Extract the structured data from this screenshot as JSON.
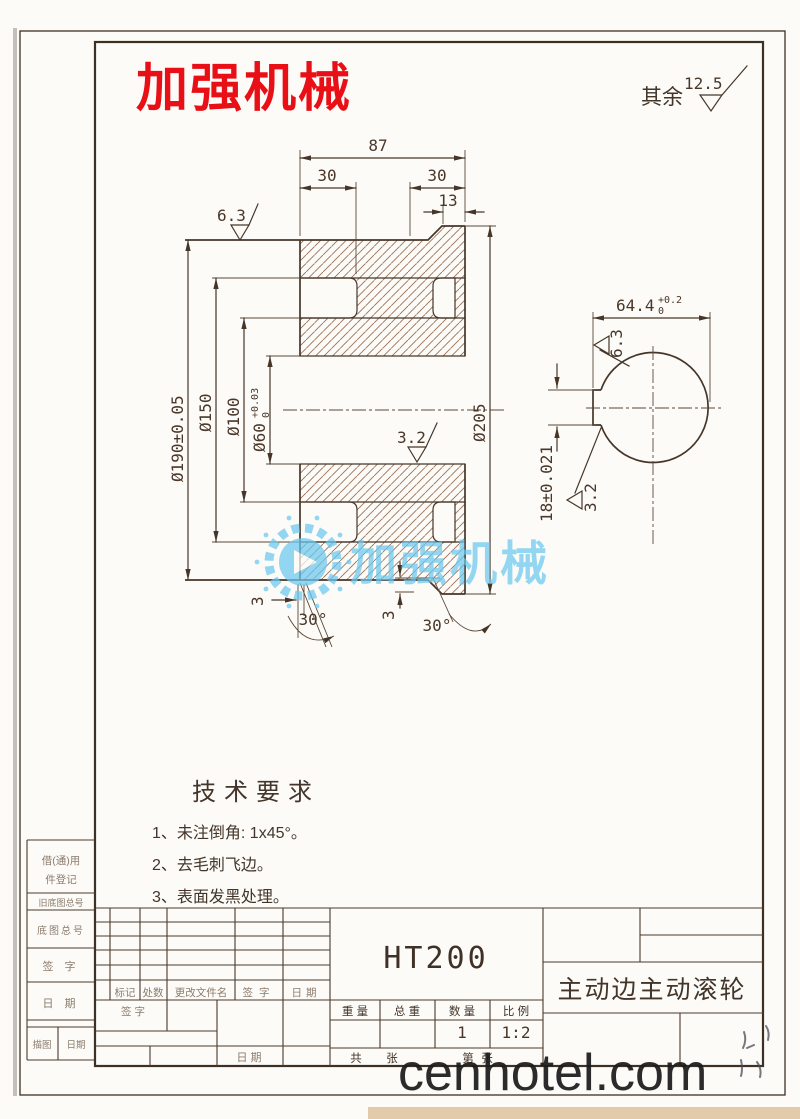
{
  "watermarks": {
    "red_brand": "加强机械",
    "center_brand": "加强机械",
    "site": "cenhotel.com"
  },
  "surface_note": {
    "label": "其余",
    "value": "12.5"
  },
  "main_view": {
    "dims": {
      "total_width": "87",
      "left_width": "30",
      "right_width": "30",
      "rim_width": "13",
      "dia_outer": "Ø190±0.05",
      "dia_groove": "Ø150",
      "dia_hub": "Ø100",
      "dia_bore": "Ø60",
      "dia_bore_tol_up": "+0.03",
      "dia_bore_tol_low": "0",
      "dia_rim": "Ø205",
      "finish_face": "6.3",
      "finish_bore": "3.2",
      "chamfer_left_depth": "3",
      "chamfer_left_angle": "30°",
      "chamfer_right_depth": "3",
      "chamfer_right_angle": "30°"
    }
  },
  "side_view": {
    "dims": {
      "keyway_span": "64.4",
      "keyway_span_tol_up": "+0.2",
      "keyway_span_tol_low": "0",
      "keyway_width": "18±0.021",
      "finish_bore": "6.3",
      "finish_keyway": "3.2"
    }
  },
  "tech_requirements": {
    "title": "技术要求",
    "items": [
      "1、未注倒角: 1x45°。",
      "2、去毛刺飞边。",
      "3、表面发黑处理。"
    ]
  },
  "title_block": {
    "material": "HT200",
    "part_name": "主动边主动滚轮",
    "rev_cols": [
      "标记",
      "处数",
      "更改文件名",
      "签字",
      "日期"
    ],
    "sign_label": "签 字",
    "date_label": "日 期",
    "spec_cols": [
      "重 量",
      "总 重",
      "数 量",
      "比 例"
    ],
    "qty_value": "1",
    "scale_value": "1:2",
    "sheet_row": [
      "共",
      "张",
      "第",
      "张"
    ]
  },
  "margin_strip": {
    "borrow_line1": "借(通)用",
    "borrow_line2": "件登记",
    "old_base_no": "旧底图总号",
    "base_no": "底图总号",
    "sign": "签 字",
    "date": "日 期",
    "trace": "描图",
    "trace_date": "日期"
  }
}
